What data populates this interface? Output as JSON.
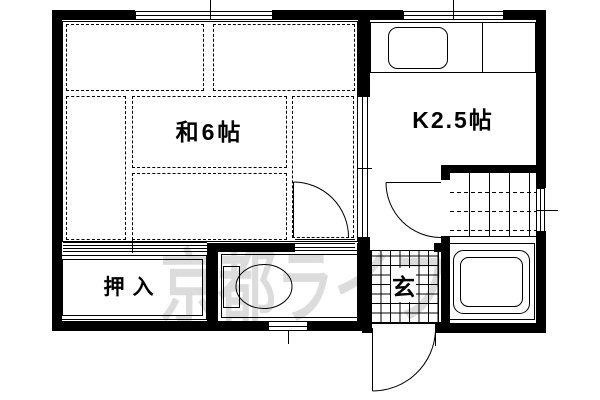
{
  "plan": {
    "type": "apartment-floor-plan",
    "rooms": {
      "washitsu": {
        "label": "和6帖"
      },
      "kitchen": {
        "label": "K2.5帖"
      },
      "closet": {
        "label": "押入"
      },
      "genkan": {
        "label": "玄"
      }
    },
    "fixtures": [
      "kitchen-sink",
      "kitchen-counter",
      "toilet",
      "bathtub",
      "bath-tile-floor",
      "genkan-tile-floor",
      "tatami-mats-x6"
    ],
    "openings": [
      "top-window-washitsu",
      "top-window-kitchen",
      "bath-window-right",
      "toilet-window-bottom",
      "entrance-door-swing",
      "bath-door-swing",
      "toilet-door-swing",
      "closet-sliding-doors",
      "kitchen-sliding-door"
    ],
    "watermark": {
      "text": "京都ライフ",
      "color": "#dcdcdc"
    },
    "colors": {
      "wall": "#000000",
      "background": "#ffffff",
      "line": "#000000"
    }
  }
}
